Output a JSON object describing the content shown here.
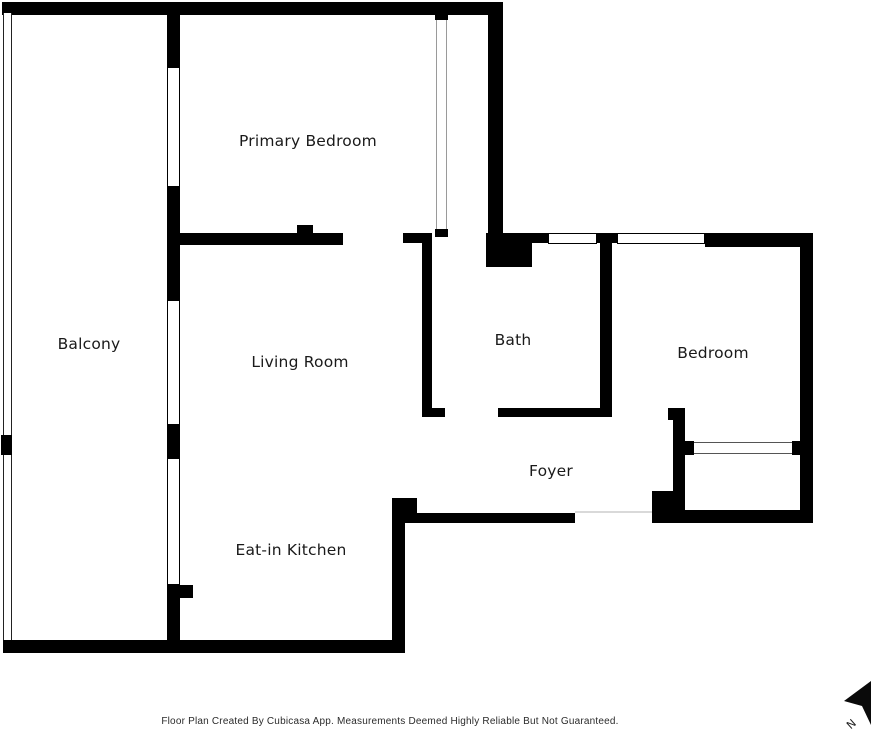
{
  "floor_plan": {
    "rooms": [
      {
        "id": "primary-bedroom",
        "label": "Primary Bedroom"
      },
      {
        "id": "balcony",
        "label": "Balcony"
      },
      {
        "id": "living-room",
        "label": "Living Room"
      },
      {
        "id": "bath",
        "label": "Bath"
      },
      {
        "id": "bedroom",
        "label": "Bedroom"
      },
      {
        "id": "foyer",
        "label": "Foyer"
      },
      {
        "id": "eat-in-kitchen",
        "label": "Eat-in Kitchen"
      }
    ],
    "compass": {
      "label": "N"
    },
    "footer": {
      "disclaimer": "Floor Plan Created By Cubicasa App. Measurements Deemed Highly Reliable But Not Guaranteed."
    },
    "colors": {
      "wall": "#000000",
      "label_text": "#1a1a1a",
      "footer_text": "#2b2b2b",
      "window_line": "#000000",
      "slider_line": "#9a9a9a",
      "threshold_line": "#d9d9d9"
    }
  }
}
